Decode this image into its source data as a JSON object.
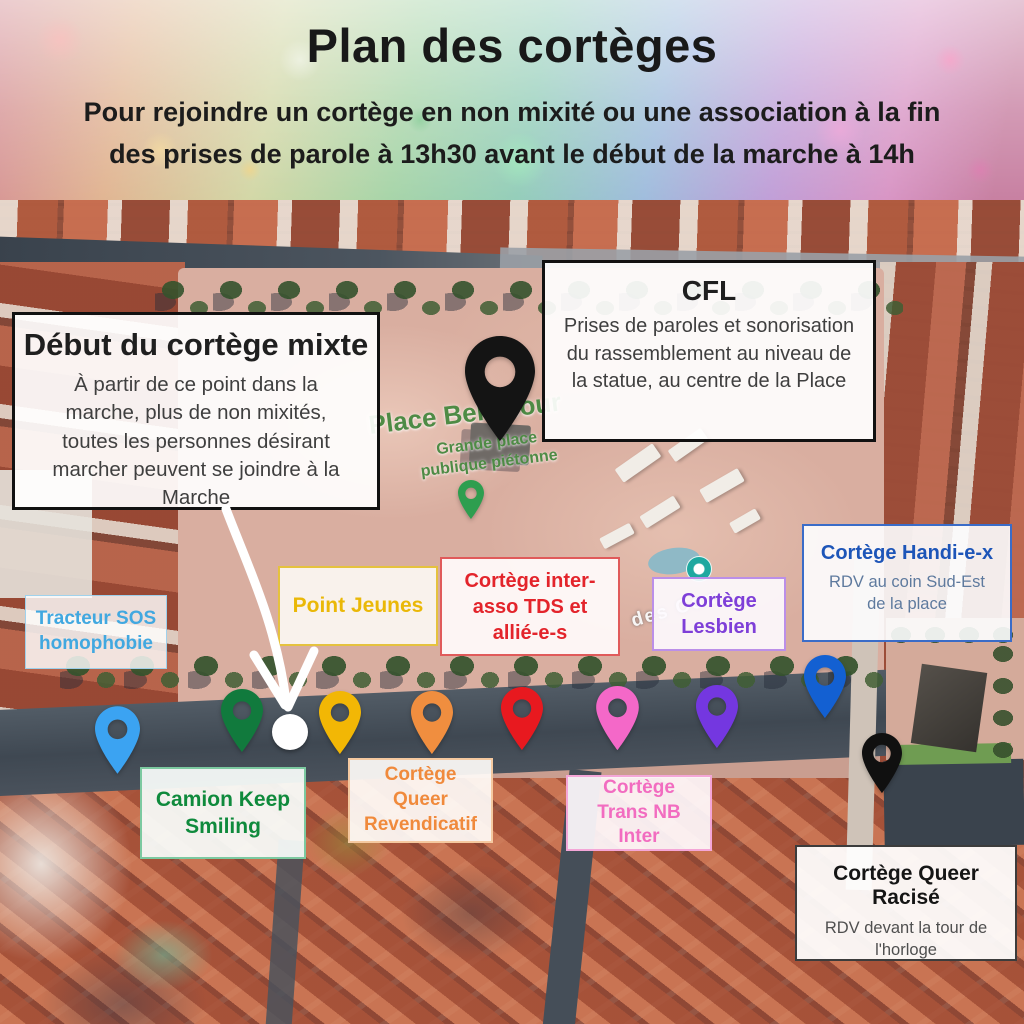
{
  "header": {
    "title": "Plan des cortèges",
    "subtitle_line1": "Pour rejoindre un cortège en non mixité ou une association à la fin",
    "subtitle_line2": "des prises de parole à 13h30 avant le début de la marche à 14h"
  },
  "map": {
    "place": {
      "name": "Place Bellecour",
      "desc_line1": "Grande place",
      "desc_line2": "publique piétonne"
    },
    "street_fragment": "des Com",
    "callouts": {
      "debut_mixte": {
        "title": "Début du cortège mixte",
        "body": "À partir de ce point dans la marche, plus de non mixités, toutes les personnes désirant marcher peuvent se joindre à la Marche"
      },
      "cfl": {
        "title": "CFL",
        "body": "Prises de paroles et sonorisation du rassemblement au niveau de la statue, au centre de la Place"
      },
      "handi": {
        "title": "Cortège Handi-e-x",
        "body": "RDV au coin Sud-Est de la place",
        "accent": "#1d55b8"
      },
      "queer_racise": {
        "title": "Cortège Queer Racisé",
        "body": "RDV devant la tour de l'horloge",
        "accent": "#111111"
      }
    },
    "labels": {
      "tracteur": {
        "text": "Tracteur SOS homophobie",
        "color": "#41a8e0"
      },
      "point_jeunes": {
        "text": "Point Jeunes",
        "color": "#eab808"
      },
      "inter_asso": {
        "text": "Cortège inter-asso TDS et allié-e-s",
        "color": "#e3242b"
      },
      "lesbien": {
        "text": "Cortège Lesbien",
        "color": "#7e3fd8"
      },
      "keep_smiling": {
        "text": "Camion Keep Smiling",
        "color": "#0f8a3c"
      },
      "queer_revendicatif": {
        "text": "Cortège Queer Revendicatif",
        "color": "#f08a3c"
      },
      "trans_nb_inter": {
        "text": "Cortège Trans NB Inter",
        "color": "#f26cc0"
      }
    },
    "pins": [
      {
        "name": "cfl-stage-pin",
        "color": "#141414"
      },
      {
        "name": "tracteur-sos-homophobie-pin",
        "color": "#3ba3f2"
      },
      {
        "name": "camion-keep-smiling-pin",
        "color": "#117a3d"
      },
      {
        "name": "point-jeunes-pin",
        "color": "#f2b705"
      },
      {
        "name": "cortege-queer-revendicatif-pin",
        "color": "#f08e3f"
      },
      {
        "name": "cortege-inter-asso-pin",
        "color": "#e8191f"
      },
      {
        "name": "cortege-trans-nb-inter-pin",
        "color": "#f468c8"
      },
      {
        "name": "cortege-lesbien-pin",
        "color": "#7437e0"
      },
      {
        "name": "cortege-handi-pin",
        "color": "#1360d2"
      },
      {
        "name": "cortege-queer-racise-pin",
        "color": "#101010"
      }
    ],
    "start_point_color": "#ffffff",
    "poi": {
      "park_marker_color": "#2e9e4f",
      "attraction_marker_color": "#1fa8a0"
    }
  }
}
